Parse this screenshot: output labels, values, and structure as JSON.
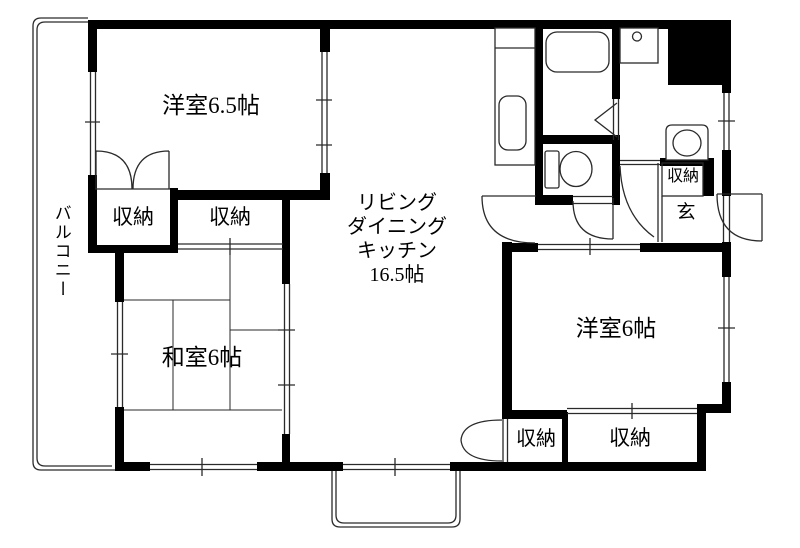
{
  "floorplan": {
    "rooms": {
      "western_room_1": {
        "label": "洋室6.5帖"
      },
      "ldk": {
        "line1": "リビング",
        "line2": "ダイニング",
        "line3": "キッチン",
        "line4": "16.5帖"
      },
      "japanese_room": {
        "label": "和室6帖"
      },
      "western_room_2": {
        "label": "洋室6帖"
      },
      "balcony": {
        "label": "バルコニー"
      },
      "entrance": {
        "label": "玄"
      }
    },
    "closets": {
      "bedroom1_left": {
        "label": "収納"
      },
      "bedroom1_right": {
        "label": "収納"
      },
      "entrance_closet": {
        "label": "収納"
      },
      "south_small": {
        "label": "収納"
      },
      "south_large": {
        "label": "収納"
      }
    },
    "colors": {
      "wall": "#000000",
      "line": "#2a2a2a",
      "background": "#ffffff",
      "text": "#000000"
    }
  }
}
